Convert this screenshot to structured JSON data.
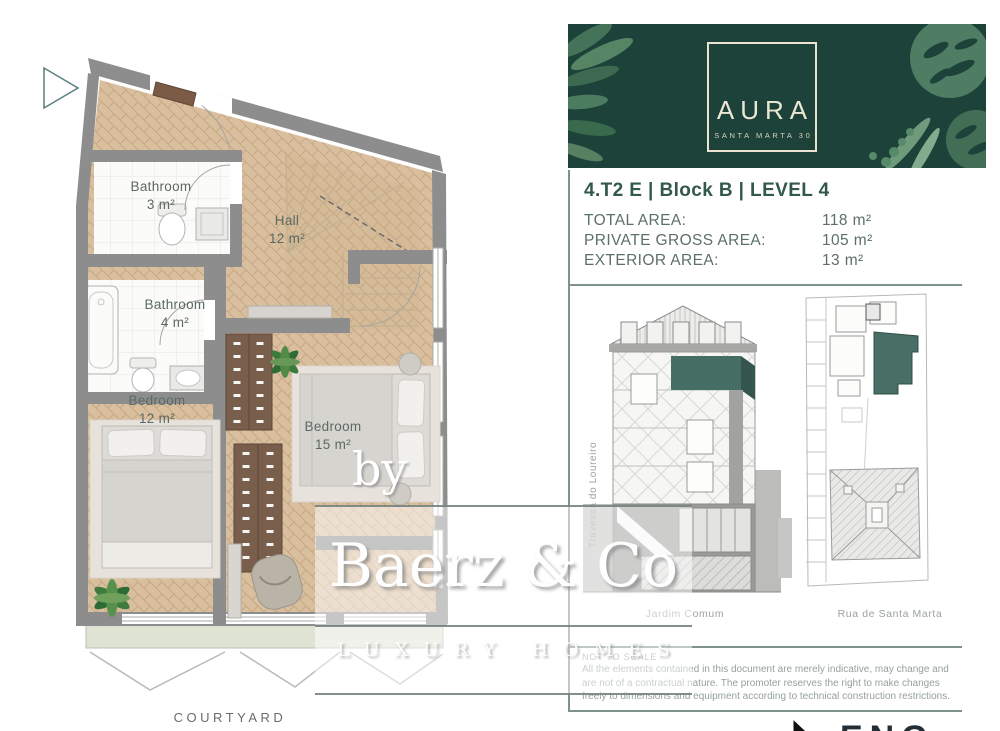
{
  "floor_plan": {
    "rooms": {
      "bathroom_small": {
        "name": "Bathroom",
        "area": "3 m²"
      },
      "bathroom_large": {
        "name": "Bathroom",
        "area": "4 m²"
      },
      "hall": {
        "name": "Hall",
        "area": "12 m²"
      },
      "bedroom_small": {
        "name": "Bedroom",
        "area": "12 m²"
      },
      "bedroom_large": {
        "name": "Bedroom",
        "area": "15 m²"
      }
    },
    "outdoor_label": "COURTYARD"
  },
  "info_panel": {
    "banner": {
      "brand_name": "AURA",
      "brand_subtitle": "SANTA MARTA 30",
      "background_color": "#1d423a",
      "frame_color": "#eae3d1"
    },
    "unit_title": "4.T2 E | Block B | LEVEL 4",
    "areas": [
      {
        "label": "TOTAL AREA:",
        "value": "118 m²"
      },
      {
        "label": "PRIVATE GROSS AREA:",
        "value": "105 m²"
      },
      {
        "label": "EXTERIOR AREA:",
        "value": "13 m²"
      }
    ],
    "drawings": {
      "street_label_left": "Travessa do Loureiro",
      "garden_label": "Jardim Comum",
      "street_label_right": "Rua de Santa Marta",
      "highlight_color": "#486e65"
    },
    "disclaimer": {
      "title": "NOT TO SCALE",
      "body": "All the elements contained in this document are merely indicative, may change and are not of a contractual nature. The promoter reserves the right to make changes freely to dimensions and equipment according to technical construction restrictions."
    }
  },
  "watermark": {
    "prefix": "by",
    "name": "Baerz & Co",
    "tagline": "LUXURY HOMES"
  },
  "footer": {
    "partial_logo": "ENG"
  }
}
